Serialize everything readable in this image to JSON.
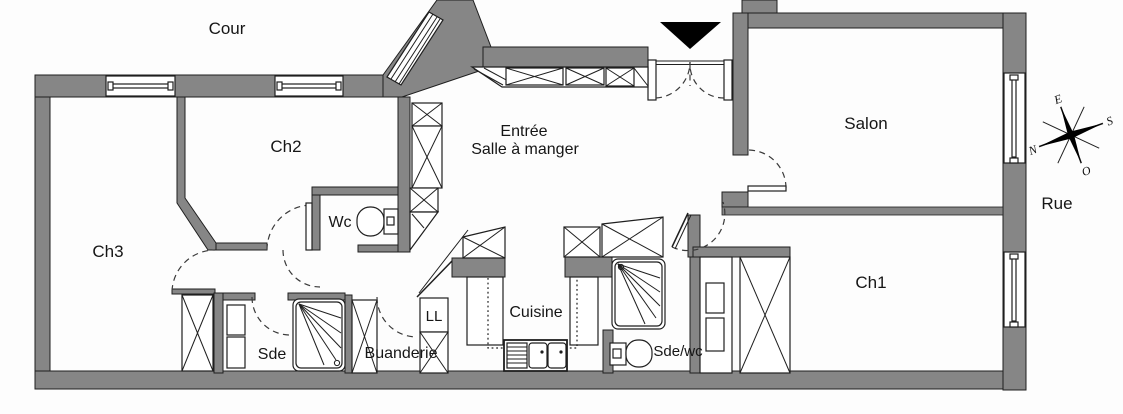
{
  "plan": {
    "colors": {
      "wall": "#868686",
      "line": "#1f1f1f",
      "background": "#fdfdfd"
    },
    "labels": {
      "cour": "Cour",
      "ch2": "Ch2",
      "ch3": "Ch3",
      "wc": "Wc",
      "entree_line1": "Entrée",
      "entree_line2": "Salle à manger",
      "salon": "Salon",
      "rue": "Rue",
      "ch1": "Ch1",
      "sde": "Sde",
      "buanderie": "Buanderie",
      "ll": "LL",
      "cuisine": "Cuisine",
      "sde_wc": "Sde/wc"
    },
    "compass": {
      "e": "E",
      "s": "S",
      "n": "N",
      "o": "O"
    }
  }
}
